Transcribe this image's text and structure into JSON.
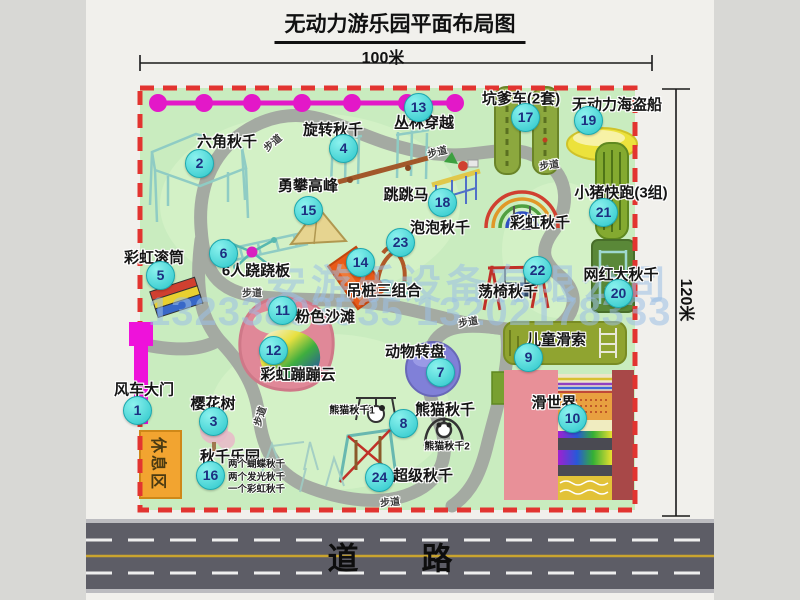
{
  "title": "无动力游乐园平面布局图",
  "dim": {
    "width": "100米",
    "height": "120米"
  },
  "road_label": "道　路",
  "walkway_label": "步道",
  "rest_area_label": "休息区",
  "rainbow_swing_label": "彩虹秋千",
  "panda_swing_1": "熊猫秋千1",
  "panda_swing_2": "熊猫秋千2",
  "swing_park_notes": [
    "两个蝴蝶秋千",
    "两个发光秋千",
    "一个彩虹秋千"
  ],
  "watermark": {
    "company": "安游乐设备有限公司",
    "phones": "13233803535 13202178333"
  },
  "colors": {
    "border_red": "#e23430",
    "badge_cyan": "#2bc6ca",
    "chain_magenta": "#e318c8",
    "map_green": "#c9ecbf",
    "path_gray": "#a4aaa2",
    "gate_magenta": "#ee12da"
  },
  "attractions": [
    {
      "num": "1",
      "name": "风车大门"
    },
    {
      "num": "2",
      "name": "六角秋千"
    },
    {
      "num": "3",
      "name": "樱花树"
    },
    {
      "num": "4",
      "name": "旋转秋千"
    },
    {
      "num": "5",
      "name": "彩虹滚筒"
    },
    {
      "num": "6",
      "name": "6人跷跷板"
    },
    {
      "num": "7",
      "name": "动物转盘"
    },
    {
      "num": "8",
      "name": "熊猫秋千"
    },
    {
      "num": "9",
      "name": "儿童滑索"
    },
    {
      "num": "10",
      "name": "滑世界"
    },
    {
      "num": "11",
      "name": "粉色沙滩"
    },
    {
      "num": "12",
      "name": "彩虹蹦蹦云"
    },
    {
      "num": "13",
      "name": "丛林穿越"
    },
    {
      "num": "14",
      "name": "吊桩三组合"
    },
    {
      "num": "15",
      "name": "勇攀高峰"
    },
    {
      "num": "16",
      "name": "秋千乐园"
    },
    {
      "num": "17",
      "name": "坑爹车(2套)"
    },
    {
      "num": "18",
      "name": "跳跳马"
    },
    {
      "num": "19",
      "name": "无动力海盗船"
    },
    {
      "num": "20",
      "name": "网红大秋千"
    },
    {
      "num": "21",
      "name": "小猪快跑(3组)"
    },
    {
      "num": "22",
      "name": "荡椅秋千"
    },
    {
      "num": "23",
      "name": "泡泡秋千"
    },
    {
      "num": "24",
      "name": "超级秋千"
    }
  ]
}
